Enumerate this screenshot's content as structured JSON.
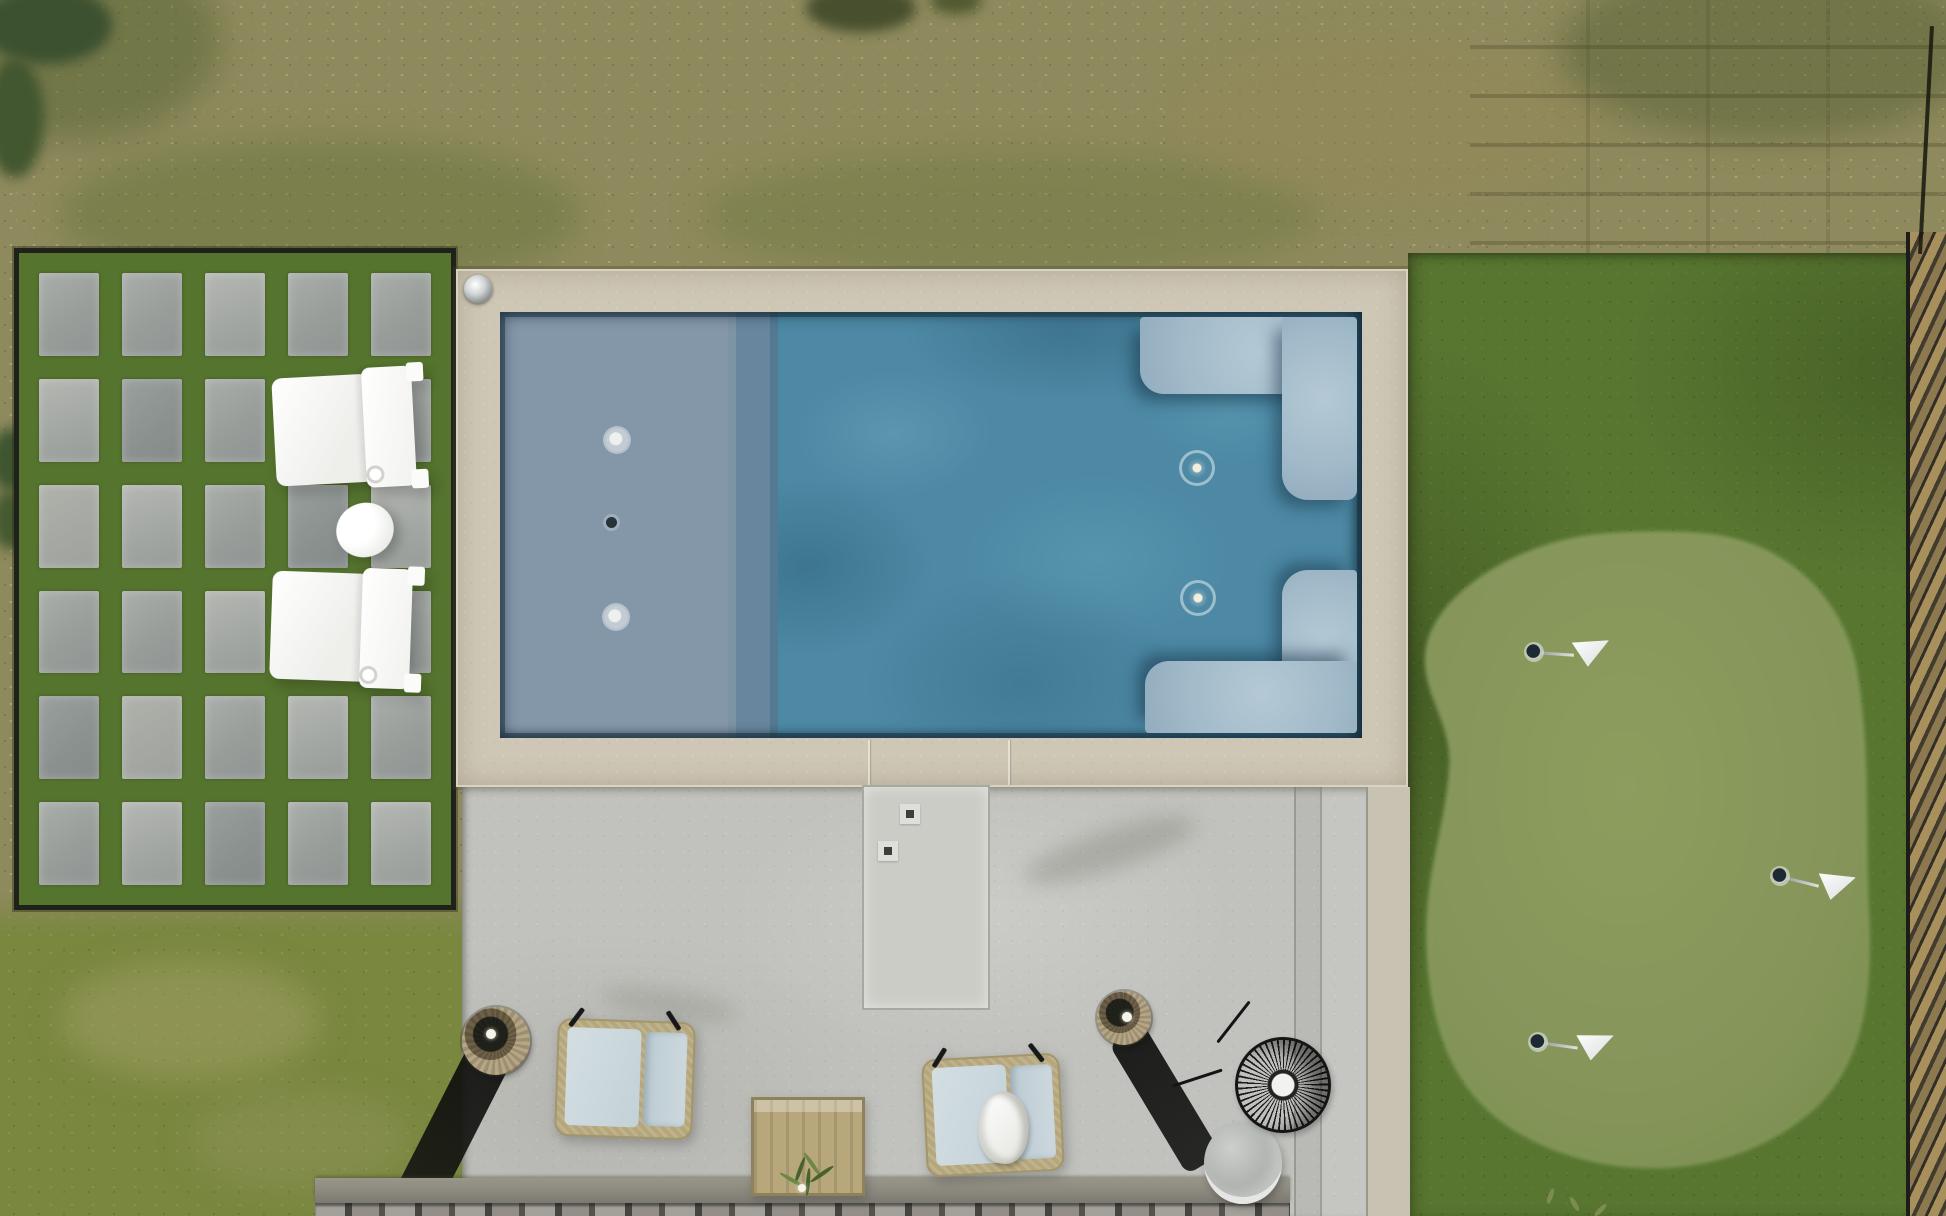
{
  "scene": {
    "label": "aerial-backyard-photo",
    "description": "Overhead drone photograph of a modern backyard with rectangular pool, tanning ledge, paver courtyard, concrete patio and artificial-turf putting green",
    "areas": {
      "dormant_lawn_top": {
        "color": "#8e8a5d"
      },
      "green_lawn_bottom_left": {
        "color": "#79873f"
      },
      "artificial_turf": {
        "color": "#587630"
      },
      "putting_green": {
        "color": "#8a9a5c",
        "flag_count": 3,
        "flag_color": "#ffffff"
      },
      "paver_courtyard": {
        "paver_color": "#a2a6a2",
        "joint_color": "#55742e",
        "rows": 6,
        "cols": 5
      },
      "pool_deck": {
        "color": "#cec7b5"
      },
      "patio": {
        "color": "#c1c2bd"
      },
      "retaining_wall": {
        "cap_color": "#8b887e",
        "picket_color": "#a4a19a"
      },
      "fence_right": {
        "color": "#a8905c"
      }
    },
    "pool": {
      "water_color": "#4d89a4",
      "tanning_ledge_color": "#8497a9",
      "bench_color": "#a2bac9",
      "main_jet_count": 2,
      "ledge_jet_count": 2,
      "drain_count": 1,
      "bench_count": 2,
      "deck_light_count": 1
    },
    "putting_green_flags": [
      {
        "x": 1534,
        "y": 652,
        "rot": 4
      },
      {
        "x": 1780,
        "y": 876,
        "rot": 14
      },
      {
        "x": 1538,
        "y": 1042,
        "rot": 8
      }
    ],
    "paver_grid": {
      "rows": 6,
      "cols": 5
    },
    "furniture": {
      "white_cube_chairs": 2,
      "white_egg_side_table": 1,
      "wicker_lounge_chairs": 2,
      "towel_on_chair": 1,
      "wood_planter_box": 1,
      "wicker_lanterns": 2,
      "wire_fire_bowl": 1,
      "concrete_drum_table": 1
    }
  }
}
